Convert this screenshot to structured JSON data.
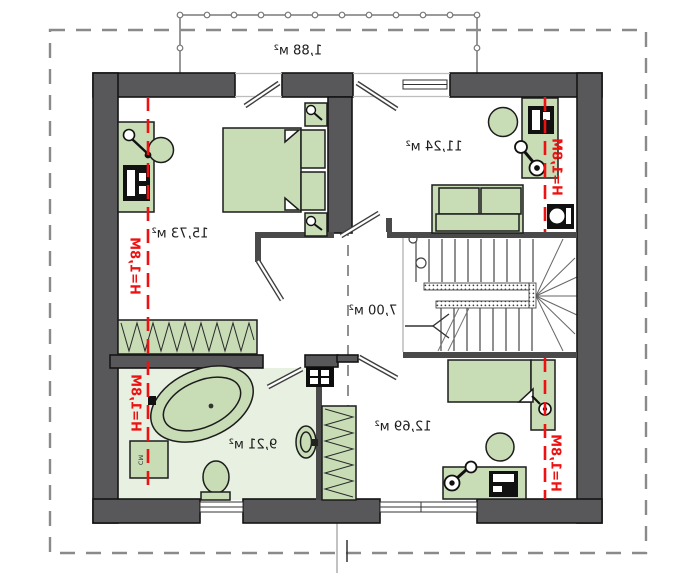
{
  "colors": {
    "wall": "#58585a",
    "wall_thin": "#4a4a4a",
    "furniture": "#c8dcb6",
    "bathroom_floor": "#e7f0e1",
    "height_line": "#ee1111",
    "outline_dash": "#8a8a8a"
  },
  "labels": {
    "balcony_area": "1,88 м²",
    "bedroom_left_area": "15,73 м²",
    "study_area": "11,24 м²",
    "hall_area": "7,00 м²",
    "bathroom_area": "9,21 м²",
    "bedroom_bottom_area": "12,69 м²",
    "height_mark": "H=1,8M",
    "washing_machine": "СМ"
  }
}
